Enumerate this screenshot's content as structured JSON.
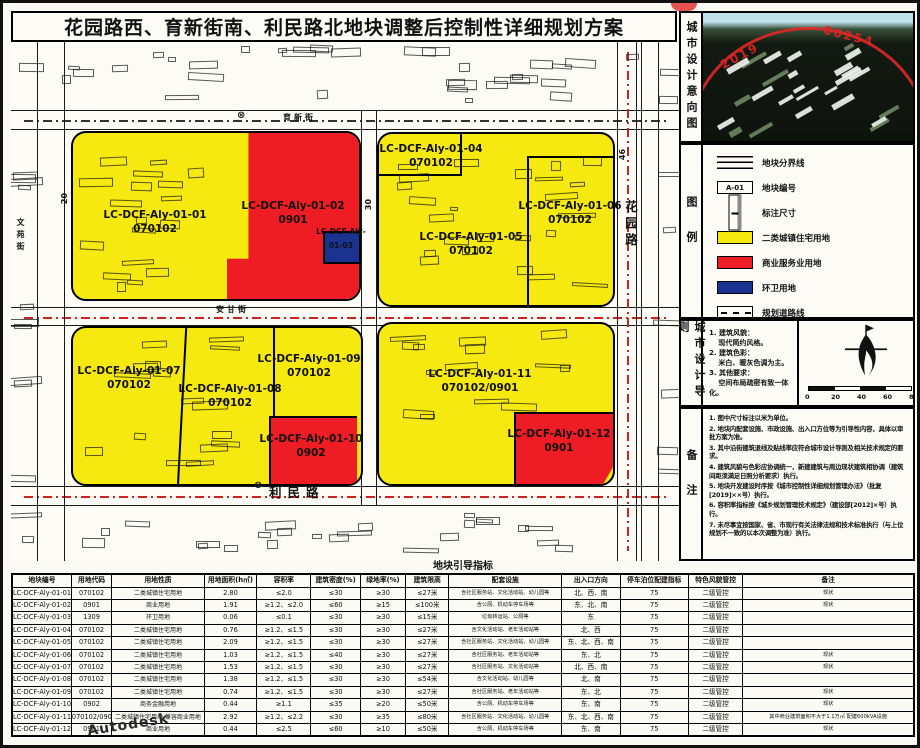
{
  "title": "花园路西、育新街南、利民路北地块调整后控制性详细规划方案",
  "watermark": "Autodesk",
  "stamp": {
    "left_text": "2019",
    "right_text": "00254"
  },
  "side_labels": {
    "intent": "城市设计意向图",
    "legend": "图例",
    "guideline": "城市设计导则",
    "notes": "备注"
  },
  "colors": {
    "residential": "#f6e90f",
    "commercial": "#ee1c25",
    "sanitation": "#1b3390",
    "planned_road": "#cc2222"
  },
  "legend": {
    "items": [
      {
        "type": "boundary",
        "label": "地块分界线"
      },
      {
        "type": "code",
        "symbol_text": "A-01",
        "label": "地块编号"
      },
      {
        "type": "dim",
        "label": "标注尺寸"
      },
      {
        "type": "fill",
        "color": "#f6e90f",
        "label": "二类城镇住宅用地"
      },
      {
        "type": "fill",
        "color": "#ee1c25",
        "label": "商业服务业用地"
      },
      {
        "type": "fill",
        "color": "#1b3390",
        "label": "环卫用地"
      },
      {
        "type": "dash",
        "label": "规划道路线"
      }
    ]
  },
  "guideline": {
    "lines": [
      "1. 建筑风貌：",
      "　 现代简约风格。",
      "2. 建筑色彩：",
      "　 米白、暖灰色调为主。",
      "3. 其他要求：",
      "　 空间布局疏密有致一体化。"
    ],
    "scale_labels": [
      "0",
      "20",
      "40",
      "60",
      "80m"
    ]
  },
  "notes": {
    "items": [
      "1. 图中尺寸标注以米为单位。",
      "2. 地块内配套设施、市政设施、出入口方位等为引导性内容，具体以审批方案为准。",
      "3. 其中沿街建筑退线及贴线率应符合城市设计导则及相关技术规定的要求。",
      "4. 建筑风貌与色彩应协调统一，新建建筑与周边现状建筑相协调（建筑间距须满足日照分析要求）执行。",
      "5. 地块开发建设时序按《城市控制性详细规划管理办法》（批复[2019]××号）执行。",
      "6. 容积率指标按《城乡规划管理技术规定》（建设部[2012]×号）执行。",
      "7. 未尽事宜按国家、省、市现行有关法律法规和技术标准执行（与上位规划不一致的以本次调整为准）执行。"
    ]
  },
  "map": {
    "parcels": [
      {
        "line1": "LC-DCF-Aly-01-01",
        "line2": "070102",
        "x": 144,
        "y": 167
      },
      {
        "line1": "LC-DCF-Aly-01-02",
        "line2": "0901",
        "x": 282,
        "y": 158
      },
      {
        "line1": "LC-DCF-Aly-",
        "line2": "",
        "x": 330,
        "y": 185,
        "small": true
      },
      {
        "line1": "01-03",
        "line2": "",
        "x": 330,
        "y": 199,
        "small": true
      },
      {
        "line1": "LC-DCF-Aly-01-04",
        "line2": "070102",
        "x": 420,
        "y": 101
      },
      {
        "line1": "LC-DCF-Aly-01-05",
        "line2": "070102",
        "x": 460,
        "y": 189
      },
      {
        "line1": "LC-DCF-Aly-01-06",
        "line2": "070102",
        "x": 559,
        "y": 158
      },
      {
        "line1": "LC-DCF-Aly-01-07",
        "line2": "070102",
        "x": 118,
        "y": 323
      },
      {
        "line1": "LC-DCF-Aly-01-08",
        "line2": "070102",
        "x": 219,
        "y": 341
      },
      {
        "line1": "LC-DCF-Aly-01-09",
        "line2": "070102",
        "x": 298,
        "y": 311
      },
      {
        "line1": "LC-DCF-Aly-01-10",
        "line2": "0902",
        "x": 300,
        "y": 391
      },
      {
        "line1": "LC-DCF-Aly-01-11",
        "line2": "070102/0901",
        "x": 469,
        "y": 326
      },
      {
        "line1": "LC-DCF-Aly-01-12",
        "line2": "0901",
        "x": 548,
        "y": 386
      }
    ],
    "road_labels": [
      {
        "text": "育新街",
        "x": 272,
        "y": 70,
        "vert": false,
        "big": false
      },
      {
        "text": "安甘街",
        "x": 205,
        "y": 262,
        "vert": false,
        "big": false
      },
      {
        "text": "利民路",
        "x": 258,
        "y": 440,
        "vert": false,
        "big": true
      },
      {
        "text": "花园路",
        "x": 610,
        "y": 158,
        "vert": true,
        "big": true
      },
      {
        "text": "文苑街",
        "x": 4,
        "y": 176,
        "vert": true,
        "big": false
      }
    ],
    "dims": [
      {
        "text": "20",
        "x": 48,
        "y": 152
      },
      {
        "text": "30",
        "x": 352,
        "y": 158
      },
      {
        "text": "46",
        "x": 606,
        "y": 108
      }
    ],
    "markers": [
      {
        "glyph": "⊗",
        "x": 226,
        "y": 68
      },
      {
        "glyph": "⊗",
        "x": 243,
        "y": 438
      }
    ]
  },
  "table": {
    "title": "地块引导指标",
    "headers": [
      "地块编号",
      "用地代码",
      "用地性质",
      "用地面积(h㎡)",
      "容积率",
      "建筑密度(%)",
      "绿地率(%)",
      "建筑限高",
      "配套设施",
      "出入口方向",
      "停车泊位配建指标",
      "特色风貌管控",
      "备注"
    ],
    "rows": [
      [
        "LC-DCF-Aly-01-01",
        "070102",
        "二类城镇住宅用地",
        "2.80",
        "≤2.0",
        "≤30",
        "≥30",
        "≤27米",
        "含社区服务站、文化活动站、幼儿园等",
        "北、西、南",
        "75",
        "二级管控",
        "现状"
      ],
      [
        "LC-DCF-Aly-01-02",
        "0901",
        "商业用地",
        "1.91",
        "≥1.2、≤2.0",
        "≤60",
        "≥15",
        "≤100米",
        "含公厕、机动车停车场等",
        "东、北、南",
        "75",
        "二级管控",
        "现状"
      ],
      [
        "LC-DCF-Aly-01-03",
        "1309",
        "环卫用地",
        "0.06",
        "≤0.1",
        "≤30",
        "≥30",
        "≤15米",
        "垃圾转运站、公厕等",
        "东",
        "75",
        "二级管控",
        ""
      ],
      [
        "LC-DCF-Aly-01-04",
        "070102",
        "二类城镇住宅用地",
        "0.76",
        "≥1.2、≤1.5",
        "≤30",
        "≥30",
        "≤27米",
        "含文化活动站、老年活动站等",
        "北、西",
        "75",
        "二级管控",
        ""
      ],
      [
        "LC-DCF-Aly-01-05",
        "070102",
        "二类城镇住宅用地",
        "2.09",
        "≥1.2、≤1.5",
        "≤30",
        "≥30",
        "≤27米",
        "含社区服务站、文化活动站、幼儿园等",
        "东、北、西、南",
        "75",
        "二级管控",
        ""
      ],
      [
        "LC-DCF-Aly-01-06",
        "070102",
        "二类城镇住宅用地",
        "1.03",
        "≥1.2、≤1.5",
        "≤40",
        "≥30",
        "≤27米",
        "含社区服务站、老年活动站等",
        "东、北",
        "75",
        "二级管控",
        "现状"
      ],
      [
        "LC-DCF-Aly-01-07",
        "070102",
        "二类城镇住宅用地",
        "1.53",
        "≥1.2、≤1.5",
        "≤30",
        "≥30",
        "≤27米",
        "含社区服务站、文化活动站等",
        "北、西、南",
        "75",
        "二级管控",
        "现状"
      ],
      [
        "LC-DCF-Aly-01-08",
        "070102",
        "二类城镇住宅用地",
        "1.38",
        "≥1.2、≤1.5",
        "≤30",
        "≥30",
        "≤54米",
        "含文化活动站、幼儿园等",
        "北、南",
        "75",
        "二级管控",
        ""
      ],
      [
        "LC-DCF-Aly-01-09",
        "070102",
        "二类城镇住宅用地",
        "0.74",
        "≥1.2、≤1.5",
        "≤30",
        "≥30",
        "≤27米",
        "含社区服务站、老年活动站等",
        "东、北",
        "75",
        "二级管控",
        "现状"
      ],
      [
        "LC-DCF-Aly-01-10",
        "0902",
        "商务金融用地",
        "0.44",
        "≥1.1",
        "≤35",
        "≥20",
        "≤50米",
        "含公厕、机动车停车场等",
        "东、南",
        "75",
        "二级管控",
        "现状"
      ],
      [
        "LC-DCF-Aly-01-11",
        "070102/0901",
        "二类城镇住宅用地 兼容商业用地",
        "2.92",
        "≥1.2、≤2.2",
        "≤30",
        "≥35",
        "≤80米",
        "含社区服务站、文化活动站、幼儿园等",
        "东、北、西、南",
        "75",
        "二级管控",
        "其中商业建筑面积不大于1.1万㎡ 配建600kVA设施"
      ],
      [
        "LC-DCF-Aly-01-12",
        "0901",
        "商业用地",
        "0.44",
        "≤2.5",
        "≤60",
        "≥10",
        "≤50米",
        "含公厕、机动车停车场等",
        "东、南",
        "75",
        "二级管控",
        "现状"
      ]
    ]
  }
}
